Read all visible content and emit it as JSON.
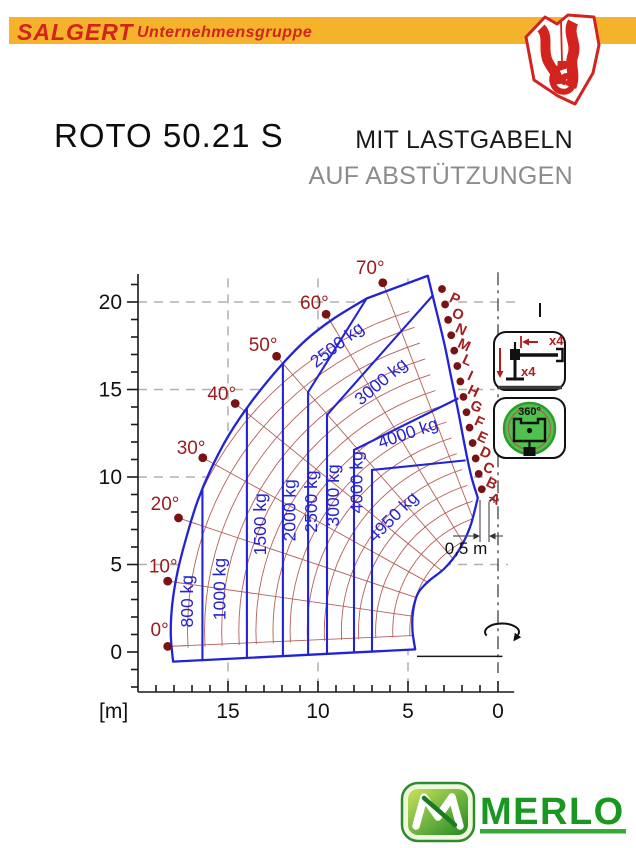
{
  "header": {
    "brand": "SALGERT",
    "brand_suffix": "Unternehmensgruppe"
  },
  "title": {
    "model": "ROTO 50.21 S",
    "subtitle_line1": "MIT LASTGABELN",
    "subtitle_line2": "AUF ABSTÜTZUNGEN"
  },
  "side_icons": {
    "outrigger_horizontal_count": "x4",
    "outrigger_vertical_count": "x4",
    "rotation_label": "360°"
  },
  "footer": {
    "brand": "MERLO"
  },
  "chart_data": {
    "type": "load-envelope",
    "units": "m",
    "xlabel": "[m]",
    "x_ticks": [
      0,
      5,
      10,
      15
    ],
    "y_ticks": [
      0,
      5,
      10,
      15,
      20
    ],
    "x_range": [
      -0.9,
      19.9
    ],
    "y_range": [
      -2.3,
      21.6
    ],
    "load_limits_kg": [
      800,
      1000,
      1500,
      2000,
      2500,
      3000,
      4000,
      4950
    ],
    "boom_angles": [
      {
        "label": "0°",
        "x": 18.35,
        "y": 0.32,
        "lx": 18.8,
        "ly": 1.25
      },
      {
        "label": "10°",
        "x": 18.35,
        "y": 4.05,
        "lx": 18.6,
        "ly": 4.9
      },
      {
        "label": "20°",
        "x": 17.75,
        "y": 7.66,
        "lx": 18.5,
        "ly": 8.45
      },
      {
        "label": "30°",
        "x": 16.4,
        "y": 11.1,
        "lx": 17.05,
        "ly": 11.65
      },
      {
        "label": "40°",
        "x": 14.6,
        "y": 14.2,
        "lx": 15.35,
        "ly": 14.75
      },
      {
        "label": "50°",
        "x": 12.3,
        "y": 16.9,
        "lx": 13.05,
        "ly": 17.55
      },
      {
        "label": "60°",
        "x": 9.55,
        "y": 19.3,
        "lx": 10.2,
        "ly": 19.95
      },
      {
        "label": "70°",
        "x": 6.4,
        "y": 21.1,
        "lx": 7.1,
        "ly": 21.95
      }
    ],
    "extension_letters": [
      {
        "label": "P",
        "x": 3.11,
        "y": 20.74
      },
      {
        "label": "O",
        "x": 2.94,
        "y": 19.86
      },
      {
        "label": "N",
        "x": 2.77,
        "y": 18.98
      },
      {
        "label": "M",
        "x": 2.6,
        "y": 18.1
      },
      {
        "label": "L",
        "x": 2.43,
        "y": 17.22
      },
      {
        "label": "I",
        "x": 2.26,
        "y": 16.34
      },
      {
        "label": "H",
        "x": 2.09,
        "y": 15.46
      },
      {
        "label": "G",
        "x": 1.92,
        "y": 14.58
      },
      {
        "label": "F",
        "x": 1.75,
        "y": 13.7
      },
      {
        "label": "E",
        "x": 1.58,
        "y": 12.82
      },
      {
        "label": "D",
        "x": 1.41,
        "y": 11.94
      },
      {
        "label": "C",
        "x": 1.24,
        "y": 11.06
      },
      {
        "label": "B",
        "x": 1.07,
        "y": 10.18
      },
      {
        "label": "A",
        "x": 0.9,
        "y": 9.3
      }
    ],
    "load_labels": [
      {
        "text": "800 kg",
        "x": 16.95,
        "y": 2.9,
        "rot": -90
      },
      {
        "text": "1000 kg",
        "x": 15.15,
        "y": 3.6,
        "rot": -90
      },
      {
        "text": "1500 kg",
        "x": 12.9,
        "y": 7.3,
        "rot": -90
      },
      {
        "text": "2000 kg",
        "x": 11.25,
        "y": 8.1,
        "rot": -90
      },
      {
        "text": "2500 kg",
        "x": 10.05,
        "y": 8.6,
        "rot": -90
      },
      {
        "text": "3000 kg",
        "x": 8.82,
        "y": 8.95,
        "rot": -90
      },
      {
        "text": "4000 kg",
        "x": 7.52,
        "y": 9.7,
        "rot": -90
      },
      {
        "text": "2500 kg",
        "x": 8.75,
        "y": 17.3,
        "rot": -38
      },
      {
        "text": "3000 kg",
        "x": 6.3,
        "y": 15.2,
        "rot": -40
      },
      {
        "text": "4000 kg",
        "x": 4.9,
        "y": 12.2,
        "rot": -19
      },
      {
        "text": "4950 kg",
        "x": 5.6,
        "y": 7.5,
        "rot": -45
      }
    ],
    "zone_boundaries": [
      {
        "x": 16.42,
        "top": 9.3
      },
      {
        "x": 13.95,
        "top": 13.95
      },
      {
        "x": 11.95,
        "top": 16.45
      },
      {
        "x": 10.55,
        "top": 14.85,
        "to": [
          7.3,
          20.2
        ]
      },
      {
        "x": 9.5,
        "top": 13.55,
        "to": [
          3.6,
          20.4
        ]
      },
      {
        "x": 8.0,
        "top": 11.55,
        "to": [
          2.2,
          14.5
        ]
      },
      {
        "x": 7.0,
        "top": 10.4,
        "to": [
          1.8,
          10.95
        ]
      }
    ],
    "envelope": {
      "outer": [
        [
          18.05,
          -0.55
        ],
        [
          18.18,
          1.0
        ],
        [
          18.1,
          2.7
        ],
        [
          17.8,
          4.6
        ],
        [
          17.3,
          6.6
        ],
        [
          16.7,
          8.6
        ],
        [
          15.95,
          10.45
        ],
        [
          14.95,
          12.4
        ],
        [
          13.7,
          14.3
        ],
        [
          12.2,
          16.2
        ],
        [
          10.7,
          17.8
        ],
        [
          9.2,
          19.0
        ],
        [
          7.3,
          20.2
        ]
      ],
      "top_corner": [
        3.9,
        21.5
      ],
      "right": [
        [
          3.45,
          19.6
        ],
        [
          3.0,
          17.7
        ],
        [
          2.6,
          15.7
        ],
        [
          2.2,
          13.7
        ],
        [
          1.85,
          11.8
        ],
        [
          1.5,
          10.1
        ],
        [
          1.12,
          8.8
        ]
      ],
      "inner": [
        [
          1.55,
          7.15
        ],
        [
          2.15,
          5.85
        ],
        [
          2.95,
          4.8
        ],
        [
          3.85,
          4.05
        ],
        [
          4.45,
          3.35
        ],
        [
          4.72,
          2.3
        ],
        [
          4.75,
          1.2
        ],
        [
          4.6,
          0.15
        ]
      ]
    },
    "grid_dashed_horizontal": [
      {
        "y": 5,
        "x_to": -0.55
      },
      {
        "y": 10,
        "x_to": 0.3
      },
      {
        "y": 15,
        "x_to": 0.2
      },
      {
        "y": 20,
        "x_to": -1.05
      }
    ],
    "grid_dashed_vertical": [
      5,
      10,
      15
    ],
    "polar_grid": {
      "pivot": [
        -1.0,
        1.2
      ],
      "radii": [
        5.9,
        6.85,
        7.8,
        8.75,
        9.7,
        10.65,
        11.6,
        12.55,
        13.5,
        14.45,
        15.4,
        16.35,
        17.3,
        18.25,
        19.2
      ],
      "sweep_deg": [
        -3,
        73
      ]
    },
    "dimension_note": {
      "label": "0,5 m"
    },
    "colors": {
      "envelope_blue": "#2323D6",
      "polar_grid_red": "#B4605A",
      "dot_red": "#791313",
      "angle_label_red": "#9D1A1A",
      "letter_label_red": "#A31F1F",
      "dashed_gray": "#B0B0B0",
      "axis_black": "#1A1A1A"
    }
  }
}
